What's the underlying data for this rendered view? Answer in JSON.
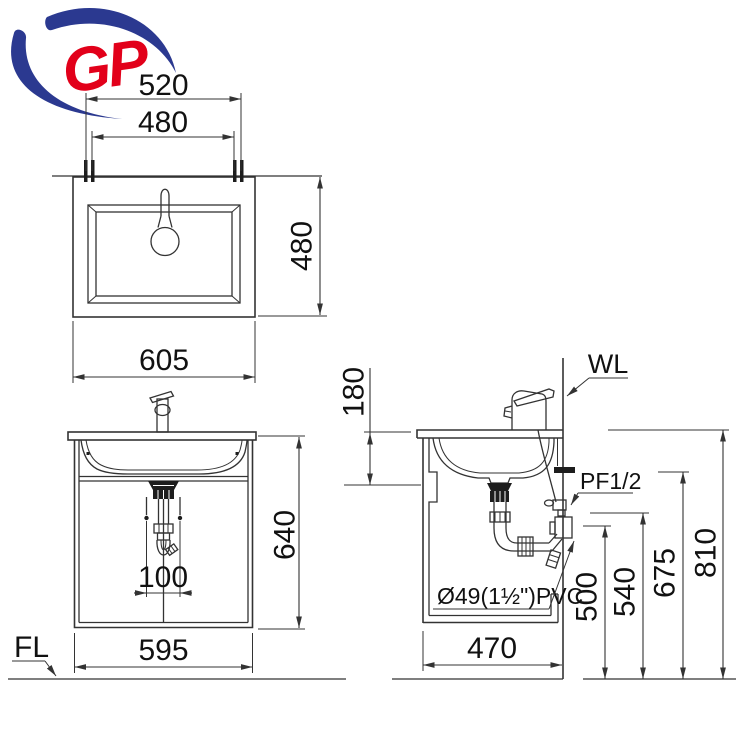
{
  "colors": {
    "line": "#333333",
    "text": "#111111",
    "logo_red": "#e2001a",
    "logo_blue": "#2b3990"
  },
  "logo": {
    "text": "GP"
  },
  "top_view": {
    "dim_bolt_span": "520",
    "dim_inner_width": "480",
    "dim_depth": "480",
    "dim_total_width": "605"
  },
  "front_view": {
    "dim_height": "640",
    "dim_drain_offset": "100",
    "dim_width": "595",
    "floor_label": "FL"
  },
  "side_view": {
    "dim_counter_to_basin": "180",
    "wall_label": "WL",
    "supply_label": "PF1/2",
    "pipe_label": "Ø49(1½\")PVC",
    "dim_drain_height": "500",
    "dim_supply_height": "540",
    "dim_bar_height": "675",
    "dim_counter_height": "810",
    "dim_depth": "470"
  }
}
